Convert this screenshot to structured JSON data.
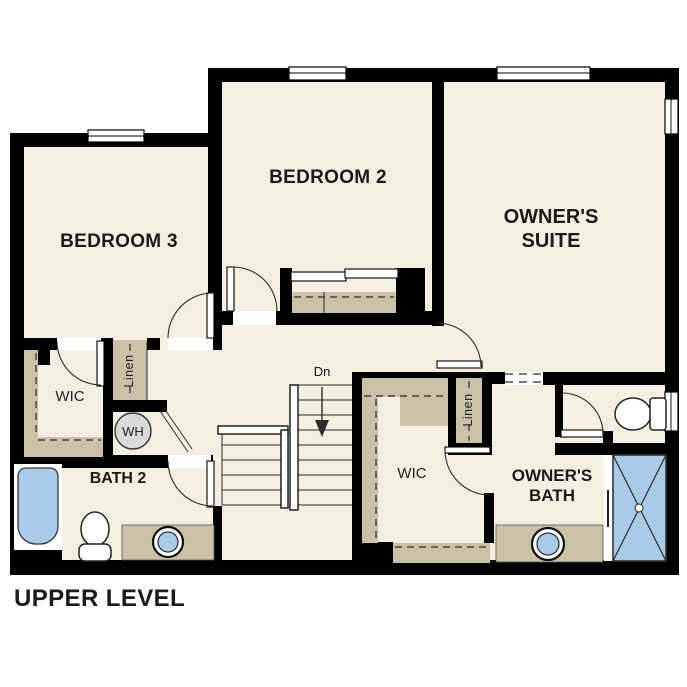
{
  "plan": {
    "title": "UPPER LEVEL",
    "rooms": {
      "bedroom3": "BEDROOM 3",
      "bedroom2": "BEDROOM 2",
      "owners_suite": "OWNER'S SUITE",
      "bath2": "BATH 2",
      "owners_bath": "OWNER'S BATH",
      "wic_left": "WIC",
      "wic_center": "WIC"
    },
    "closets": {
      "linen_left": "Linen",
      "linen_center": "Linen"
    },
    "appliances": {
      "water_heater": "WH"
    },
    "stairs": {
      "down_label": "Dn"
    },
    "colors": {
      "floor": "#F6EEE1",
      "wall": "#000000",
      "shelf": "#CBC1A9",
      "fixture": "#A9CBEA",
      "appliance": "#DADADA",
      "line": "#2B2B2B",
      "bg": "#FFFFFF",
      "text": "#1A1A1A"
    }
  }
}
